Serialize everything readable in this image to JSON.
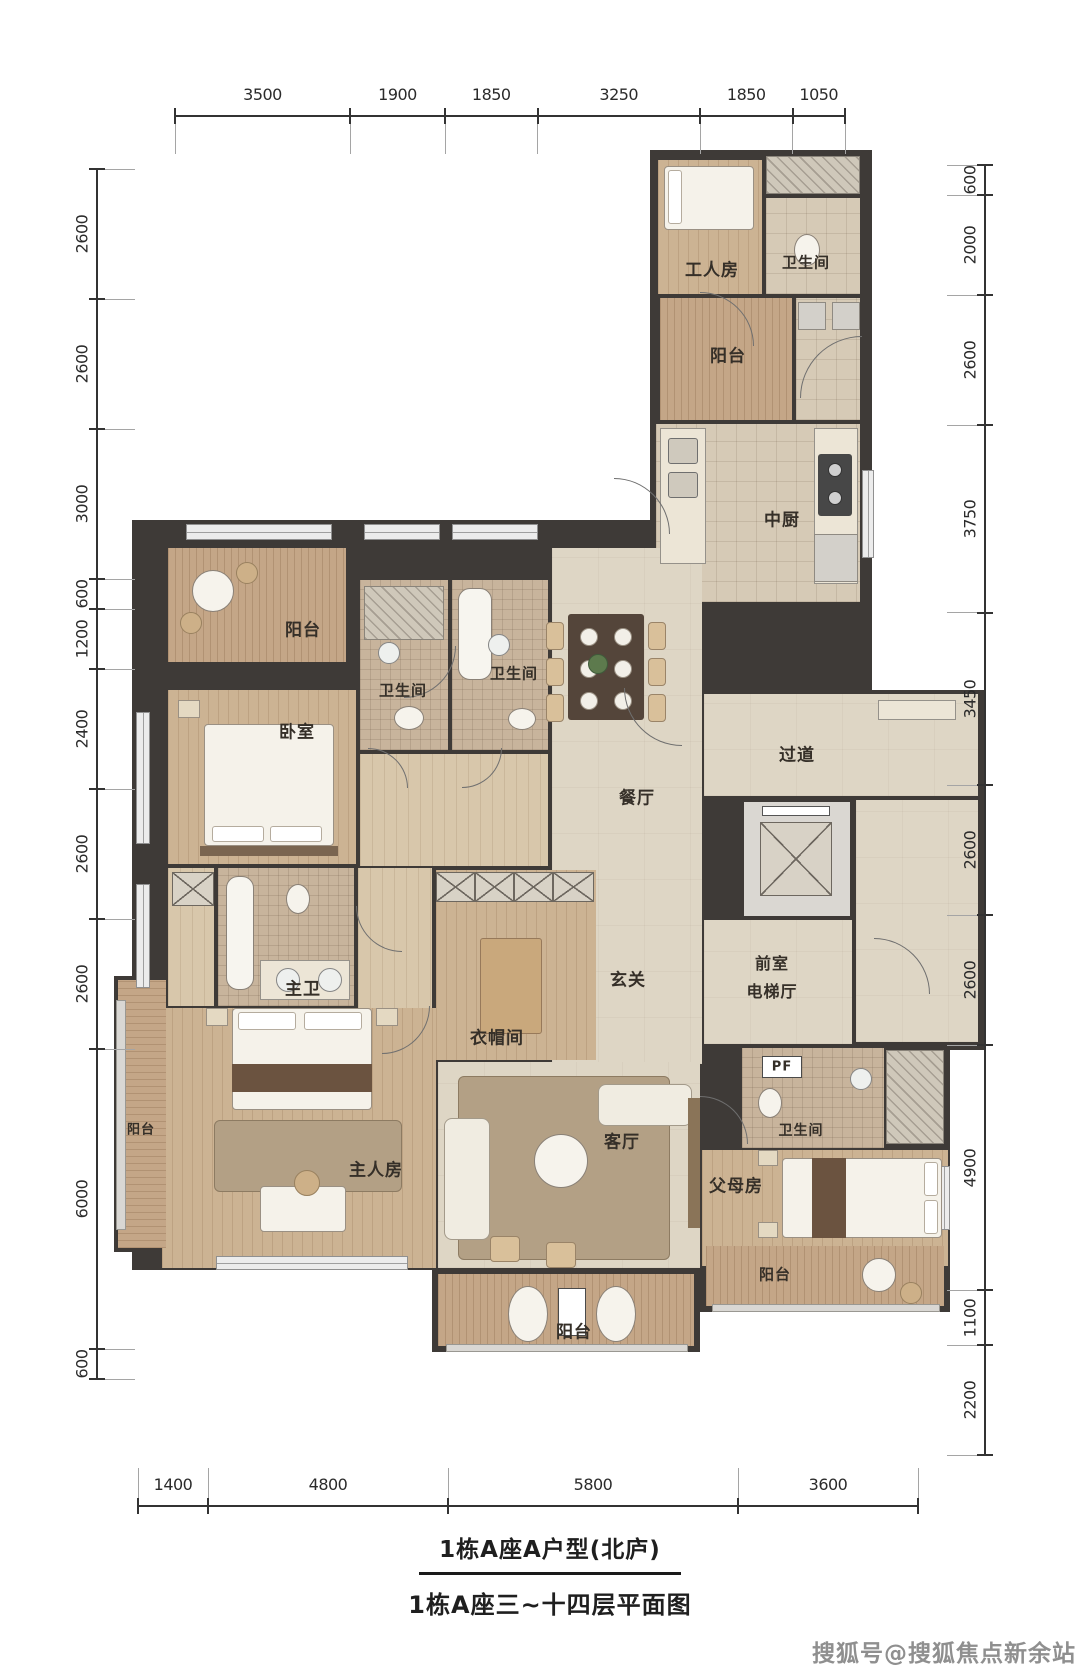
{
  "title": {
    "line1": "1栋A座A户型(北庐)",
    "line2": "1栋A座三~十四层平面图"
  },
  "watermark": {
    "text": "搜狐号@搜狐焦点新余站"
  },
  "dimensions": {
    "top": [
      3500,
      1900,
      1850,
      3250,
      1850,
      1050
    ],
    "left": [
      2600,
      2600,
      3000,
      600,
      1200,
      2400,
      2600,
      2600,
      6000,
      600
    ],
    "right": [
      600,
      2000,
      2600,
      3750,
      3450,
      2600,
      2600,
      4900,
      1100,
      2200
    ],
    "bottom": [
      1400,
      4800,
      5800,
      3600
    ]
  },
  "rooms": [
    {
      "id": "gongrenfang",
      "label": "工人房"
    },
    {
      "id": "weishengjian_fuwu",
      "label": "卫生间"
    },
    {
      "id": "yangtai_fuwu",
      "label": "阳台"
    },
    {
      "id": "zhongchu",
      "label": "中厨"
    },
    {
      "id": "yangtai_zuoshang",
      "label": "阳台"
    },
    {
      "id": "woshi",
      "label": "卧室"
    },
    {
      "id": "weishengjian_1",
      "label": "卫生间"
    },
    {
      "id": "weishengjian_2",
      "label": "卫生间"
    },
    {
      "id": "canting",
      "label": "餐厅"
    },
    {
      "id": "guodao",
      "label": "过道"
    },
    {
      "id": "zhuwei",
      "label": "主卫"
    },
    {
      "id": "yimaojian",
      "label": "衣帽间"
    },
    {
      "id": "xuanguan",
      "label": "玄关"
    },
    {
      "id": "qianshi",
      "label": "前室"
    },
    {
      "id": "diantiting",
      "label": "电梯厅"
    },
    {
      "id": "yangtai_zuo",
      "label": "阳台"
    },
    {
      "id": "zhurenfang",
      "label": "主人房"
    },
    {
      "id": "keting",
      "label": "客厅"
    },
    {
      "id": "fumufang",
      "label": "父母房"
    },
    {
      "id": "weishengjian_fumu",
      "label": "卫生间"
    },
    {
      "id": "pf",
      "label": "PF"
    },
    {
      "id": "yangtai_youxia",
      "label": "阳台"
    },
    {
      "id": "yangtai_xia",
      "label": "阳台"
    }
  ],
  "colors": {
    "wall": "#3e3a37",
    "wood_floor": "#ccb393",
    "balcony_wood": "#c4a687",
    "tile": "#d6cab6",
    "marble": "#ded6c5",
    "dim_text": "#2b2b2b",
    "title_text": "#1f1f1f",
    "watermark_text": "#8f8f8f"
  }
}
